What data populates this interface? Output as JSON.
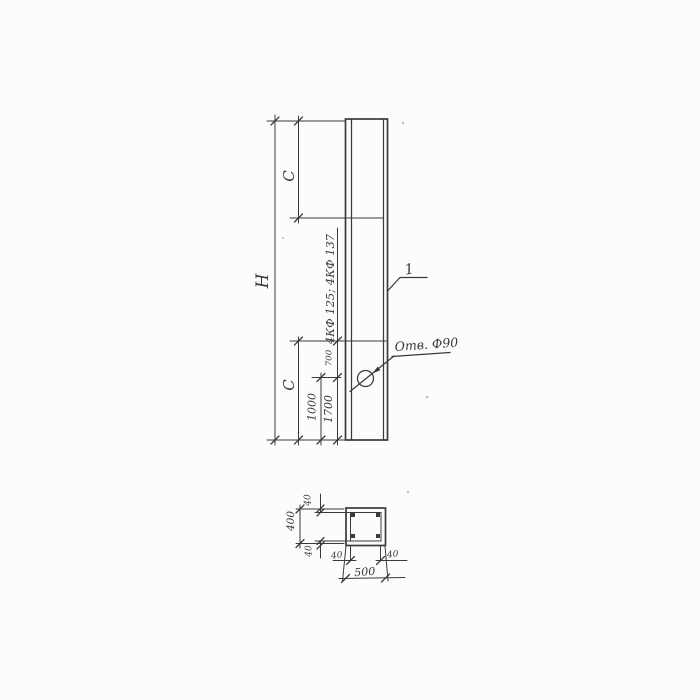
{
  "colors": {
    "ink": "#3a3a3a",
    "paper": "#fcfcfc"
  },
  "elevation": {
    "height_label": "H",
    "top_segment_label": "C",
    "bottom_segment_label": "C",
    "series_mark": "4КФ 125; 4КФ 137",
    "hole_offset_dim": "700",
    "hole_bottom_dim": "1000",
    "segment_bottom_dim": "1700",
    "hole_callout": "Отв. Ф90",
    "part_number": "1"
  },
  "section": {
    "overall_width": "500",
    "overall_height": "400",
    "cover_top": "40",
    "cover_bottom": "40",
    "cover_left": "40",
    "cover_right": "40"
  }
}
